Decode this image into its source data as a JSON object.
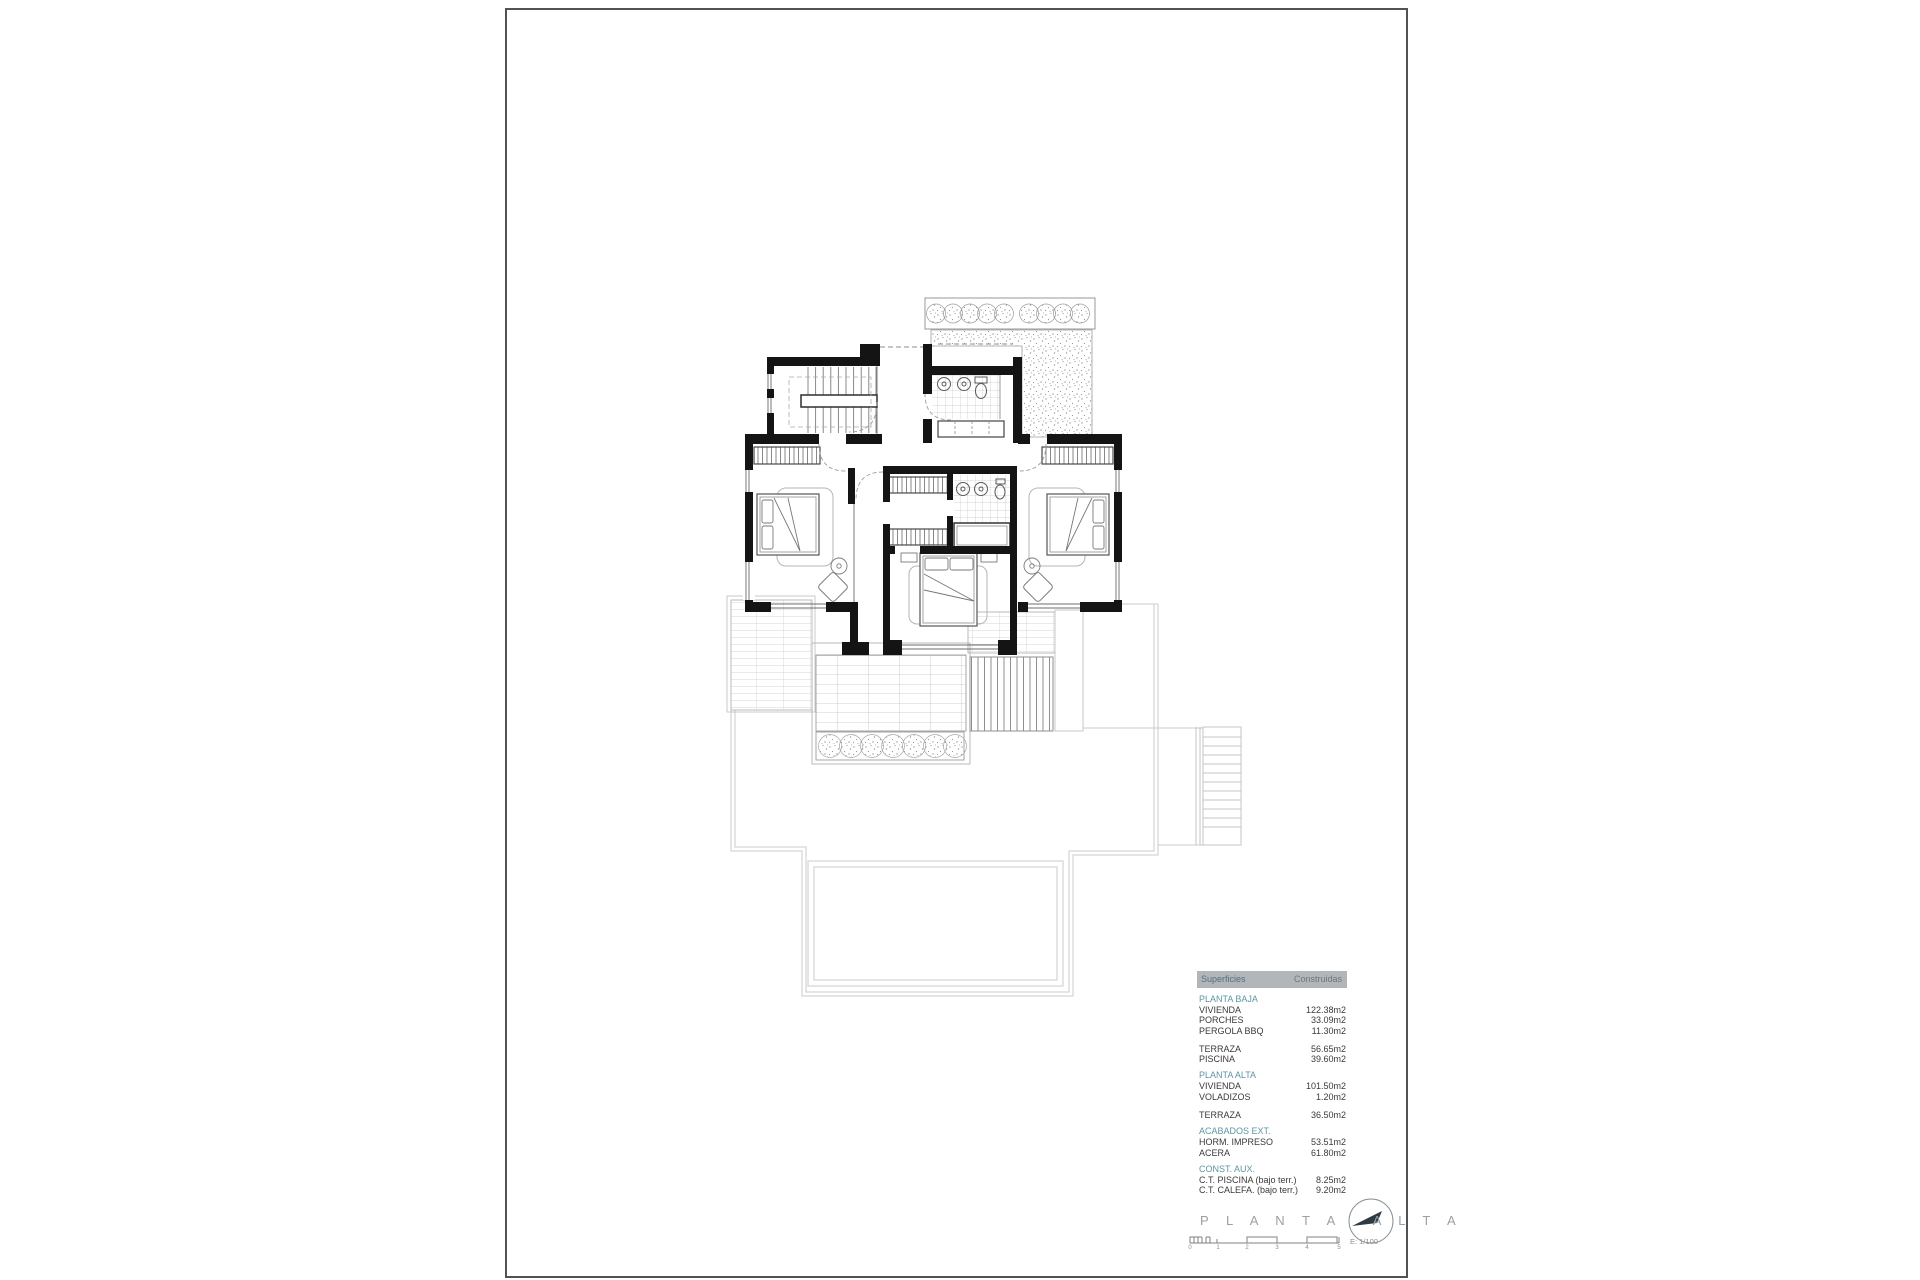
{
  "document": {
    "type": "architectural-floor-plan",
    "sheet_background": "#ffffff"
  },
  "table": {
    "header": {
      "col1": "Superficies",
      "col2": "Construidas"
    },
    "groups": [
      {
        "title": "PLANTA BAJA",
        "rows": [
          {
            "label": "VIVIENDA",
            "value": "122.38m2"
          },
          {
            "label": "PORCHES",
            "value": "33.09m2"
          },
          {
            "label": "PERGOLA BBQ",
            "value": "11.30m2"
          }
        ]
      },
      {
        "title": "",
        "rows": [
          {
            "label": "TERRAZA",
            "value": "56.65m2"
          },
          {
            "label": "PISCINA",
            "value": "39.60m2"
          }
        ]
      },
      {
        "title": "PLANTA ALTA",
        "rows": [
          {
            "label": "VIVIENDA",
            "value": "101.50m2"
          },
          {
            "label": "VOLADIZOS",
            "value": "1.20m2"
          }
        ]
      },
      {
        "title": "",
        "rows": [
          {
            "label": "TERRAZA",
            "value": "36.50m2"
          }
        ]
      },
      {
        "title": "ACABADOS EXT.",
        "rows": [
          {
            "label": "HORM. IMPRESO",
            "value": "53.51m2"
          },
          {
            "label": "ACERA",
            "value": "61.80m2"
          }
        ]
      },
      {
        "title": "CONST. AUX.",
        "rows": [
          {
            "label": "C.T. PISCINA (bajo terr.)",
            "value": "8.25m2"
          },
          {
            "label": "C.T. CALEFA. (bajo terr.)",
            "value": "9.20m2"
          }
        ]
      }
    ]
  },
  "title_block": {
    "title": "P L A N T A   A L T A",
    "scale_text": "E: 1/100",
    "scale_ticks": [
      "0",
      "1",
      "2",
      "3",
      "4",
      "5"
    ]
  },
  "colors": {
    "accent_teal": "#5e96a3",
    "wall_black": "#141414",
    "header_bar_gray": "#b2b6b8",
    "ground_floor_gray": "#cbcbcb",
    "title_gray": "#9aa0a3"
  }
}
